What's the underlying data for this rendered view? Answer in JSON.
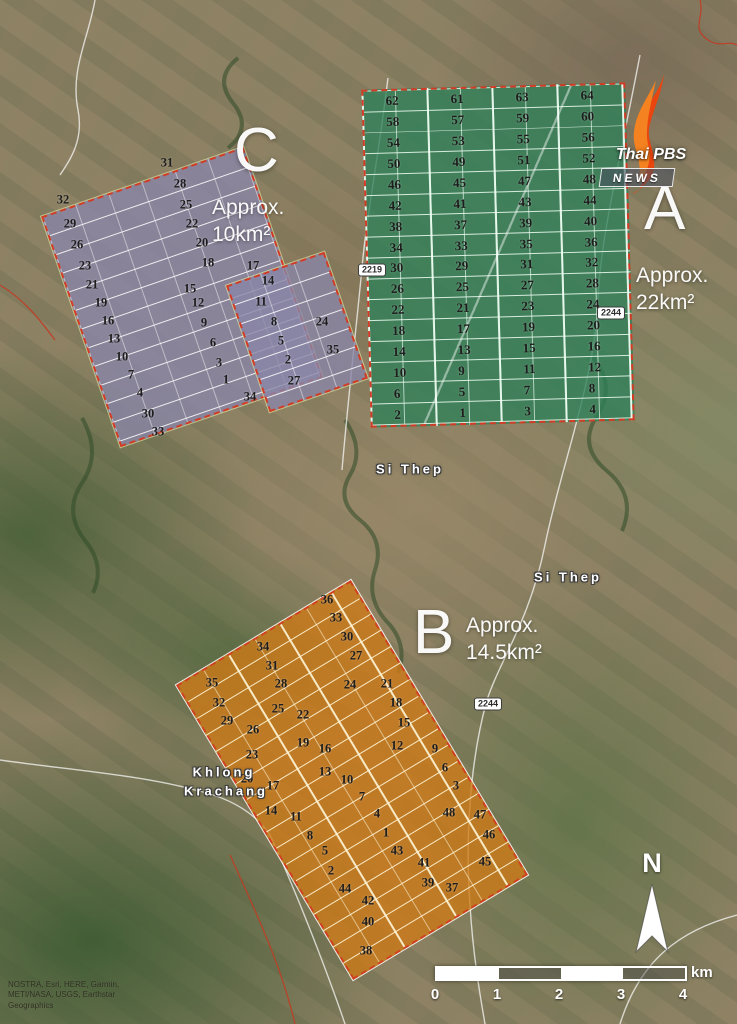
{
  "logo": {
    "brand": "Thai PBS",
    "news": "NEWS"
  },
  "zones": {
    "a": {
      "letter": "A",
      "approx_line1": "Approx.",
      "approx_line2": "22km²",
      "rows": [
        [
          62,
          61,
          63,
          64
        ],
        [
          58,
          57,
          59,
          60
        ],
        [
          54,
          53,
          55,
          56
        ],
        [
          50,
          49,
          51,
          52
        ],
        [
          46,
          45,
          47,
          48
        ],
        [
          42,
          41,
          43,
          44
        ],
        [
          38,
          37,
          39,
          40
        ],
        [
          34,
          33,
          35,
          36
        ],
        [
          30,
          29,
          31,
          32
        ],
        [
          26,
          25,
          27,
          28
        ],
        [
          22,
          21,
          23,
          24
        ],
        [
          18,
          17,
          19,
          20
        ],
        [
          14,
          13,
          15,
          16
        ],
        [
          10,
          9,
          11,
          12
        ],
        [
          6,
          5,
          7,
          8
        ],
        [
          2,
          1,
          3,
          4
        ]
      ]
    },
    "b": {
      "letter": "B",
      "approx_line1": "Approx.",
      "approx_line2": "14.5km²",
      "numbers": [
        {
          "n": 36,
          "x": 327,
          "y": 600
        },
        {
          "n": 33,
          "x": 336,
          "y": 618
        },
        {
          "n": 30,
          "x": 347,
          "y": 637
        },
        {
          "n": 27,
          "x": 356,
          "y": 656
        },
        {
          "n": 34,
          "x": 263,
          "y": 647
        },
        {
          "n": 31,
          "x": 272,
          "y": 666
        },
        {
          "n": 28,
          "x": 281,
          "y": 684
        },
        {
          "n": 35,
          "x": 212,
          "y": 683
        },
        {
          "n": 24,
          "x": 350,
          "y": 685
        },
        {
          "n": 21,
          "x": 387,
          "y": 684
        },
        {
          "n": 32,
          "x": 219,
          "y": 703
        },
        {
          "n": 25,
          "x": 278,
          "y": 709
        },
        {
          "n": 22,
          "x": 303,
          "y": 715
        },
        {
          "n": 18,
          "x": 396,
          "y": 703
        },
        {
          "n": 29,
          "x": 227,
          "y": 721
        },
        {
          "n": 26,
          "x": 253,
          "y": 730
        },
        {
          "n": 15,
          "x": 404,
          "y": 723
        },
        {
          "n": 19,
          "x": 303,
          "y": 743
        },
        {
          "n": 16,
          "x": 325,
          "y": 749
        },
        {
          "n": 12,
          "x": 397,
          "y": 746
        },
        {
          "n": 9,
          "x": 435,
          "y": 749
        },
        {
          "n": 23,
          "x": 252,
          "y": 755
        },
        {
          "n": 13,
          "x": 325,
          "y": 772
        },
        {
          "n": 10,
          "x": 347,
          "y": 780
        },
        {
          "n": 6,
          "x": 445,
          "y": 768
        },
        {
          "n": 20,
          "x": 247,
          "y": 779
        },
        {
          "n": 17,
          "x": 273,
          "y": 786
        },
        {
          "n": 7,
          "x": 362,
          "y": 797
        },
        {
          "n": 3,
          "x": 456,
          "y": 786
        },
        {
          "n": 14,
          "x": 271,
          "y": 811
        },
        {
          "n": 11,
          "x": 296,
          "y": 817
        },
        {
          "n": 4,
          "x": 377,
          "y": 814
        },
        {
          "n": 1,
          "x": 386,
          "y": 833
        },
        {
          "n": 8,
          "x": 310,
          "y": 836
        },
        {
          "n": 48,
          "x": 449,
          "y": 813
        },
        {
          "n": 47,
          "x": 480,
          "y": 815
        },
        {
          "n": 5,
          "x": 325,
          "y": 851
        },
        {
          "n": 43,
          "x": 397,
          "y": 851
        },
        {
          "n": 46,
          "x": 489,
          "y": 835
        },
        {
          "n": 2,
          "x": 331,
          "y": 871
        },
        {
          "n": 41,
          "x": 424,
          "y": 863
        },
        {
          "n": 45,
          "x": 485,
          "y": 862
        },
        {
          "n": 44,
          "x": 345,
          "y": 889
        },
        {
          "n": 39,
          "x": 428,
          "y": 883
        },
        {
          "n": 37,
          "x": 452,
          "y": 888
        },
        {
          "n": 42,
          "x": 368,
          "y": 901
        },
        {
          "n": 40,
          "x": 368,
          "y": 922
        },
        {
          "n": 38,
          "x": 366,
          "y": 951
        }
      ]
    },
    "c": {
      "letter": "C",
      "approx_line1": "Approx.",
      "approx_line2": "10km²",
      "numbers": [
        {
          "n": 31,
          "x": 167,
          "y": 163
        },
        {
          "n": 28,
          "x": 180,
          "y": 184
        },
        {
          "n": 25,
          "x": 186,
          "y": 205
        },
        {
          "n": 22,
          "x": 192,
          "y": 224
        },
        {
          "n": 20,
          "x": 202,
          "y": 243
        },
        {
          "n": 18,
          "x": 208,
          "y": 263
        },
        {
          "n": 17,
          "x": 253,
          "y": 266
        },
        {
          "n": 15,
          "x": 190,
          "y": 289
        },
        {
          "n": 14,
          "x": 268,
          "y": 281
        },
        {
          "n": 12,
          "x": 198,
          "y": 303
        },
        {
          "n": 11,
          "x": 261,
          "y": 302
        },
        {
          "n": 24,
          "x": 322,
          "y": 322
        },
        {
          "n": 9,
          "x": 204,
          "y": 323
        },
        {
          "n": 8,
          "x": 274,
          "y": 322
        },
        {
          "n": 35,
          "x": 333,
          "y": 350
        },
        {
          "n": 6,
          "x": 213,
          "y": 343
        },
        {
          "n": 5,
          "x": 281,
          "y": 341
        },
        {
          "n": 3,
          "x": 219,
          "y": 363
        },
        {
          "n": 2,
          "x": 288,
          "y": 360
        },
        {
          "n": 1,
          "x": 226,
          "y": 380
        },
        {
          "n": 27,
          "x": 294,
          "y": 381
        },
        {
          "n": 34,
          "x": 250,
          "y": 397
        },
        {
          "n": 32,
          "x": 63,
          "y": 200
        },
        {
          "n": 29,
          "x": 70,
          "y": 224
        },
        {
          "n": 26,
          "x": 77,
          "y": 245
        },
        {
          "n": 23,
          "x": 85,
          "y": 266
        },
        {
          "n": 21,
          "x": 92,
          "y": 285
        },
        {
          "n": 19,
          "x": 101,
          "y": 303
        },
        {
          "n": 16,
          "x": 108,
          "y": 321
        },
        {
          "n": 13,
          "x": 114,
          "y": 339
        },
        {
          "n": 10,
          "x": 122,
          "y": 357
        },
        {
          "n": 7,
          "x": 131,
          "y": 375
        },
        {
          "n": 4,
          "x": 140,
          "y": 393
        },
        {
          "n": 30,
          "x": 148,
          "y": 414
        },
        {
          "n": 33,
          "x": 158,
          "y": 432
        }
      ]
    }
  },
  "roads": [
    {
      "label": "2219",
      "x": 372,
      "y": 270
    },
    {
      "label": "2244",
      "x": 611,
      "y": 313
    },
    {
      "label": "2244",
      "x": 488,
      "y": 704
    }
  ],
  "places": [
    {
      "name": "Si Thep",
      "x": 410,
      "y": 469
    },
    {
      "name": "Si Thep",
      "x": 568,
      "y": 577
    },
    {
      "name": "Khlong",
      "x": 224,
      "y": 772
    },
    {
      "name": "Krachang",
      "x": 226,
      "y": 791
    }
  ],
  "north_label": "N",
  "scalebar": {
    "ticks": [
      "0",
      "1",
      "2",
      "3",
      "4"
    ],
    "unit": "km"
  },
  "attribution": [
    "NOSTRA, Esri, HERE, Garmin,",
    "METI/NASA, USGS, Earthstar",
    "Geographics"
  ]
}
